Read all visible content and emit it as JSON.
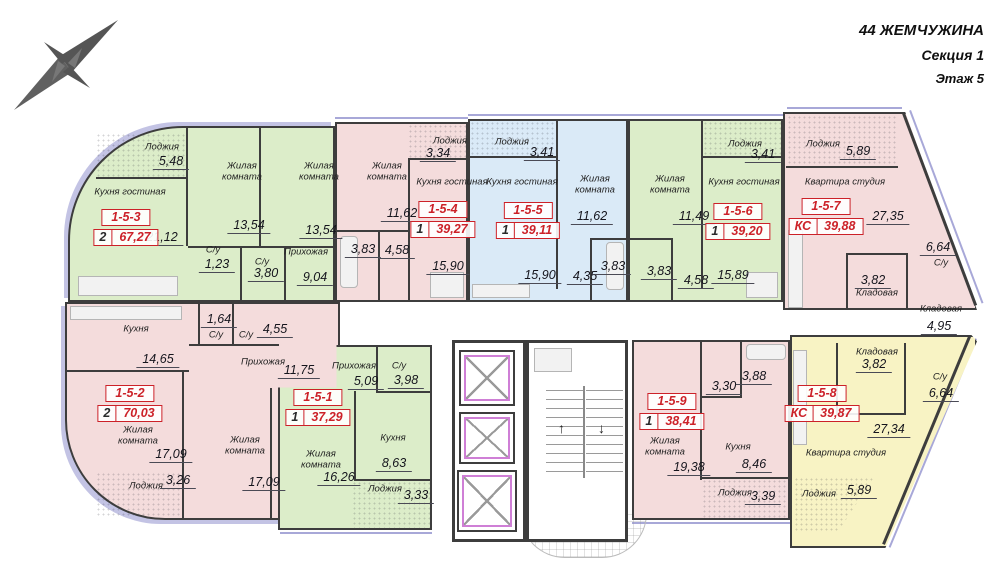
{
  "header": {
    "project": "44 ЖЕМЧУЖИНА",
    "section": "Секция 1",
    "floor": "Этаж 5"
  },
  "icons": {
    "compass": "compass-rose-icon",
    "elevator": "elevator-cabin",
    "stairs": "staircase",
    "entrance": "entrance-canopy"
  },
  "colors": {
    "room_green": "#dcedc9",
    "room_pink": "#f4dcdc",
    "room_blue": "#daeaf7",
    "room_yellow": "#f8f3c4",
    "highlight_red": "#cc2128",
    "wall": "#3d3d3d",
    "window": "#a8a8d8"
  },
  "corridor": {
    "storage_name": "Кладовая",
    "storage_area": "4,95"
  },
  "apartments": [
    {
      "id": "1-5-1",
      "count": "1",
      "total": "37,29",
      "rooms": [
        {
          "name": "Прихожая",
          "area": "5,09"
        },
        {
          "name": "С/у",
          "area": "3,98"
        },
        {
          "name": "Кухня",
          "area": "8,63"
        },
        {
          "name": "Жилая комната",
          "area": "16,26"
        },
        {
          "name": "Лоджия",
          "area": "3,33"
        }
      ]
    },
    {
      "id": "1-5-2",
      "count": "2",
      "total": "70,03",
      "rooms": [
        {
          "name": "Кухня",
          "area": "14,65"
        },
        {
          "name": "С/у",
          "area": "1,64"
        },
        {
          "name": "С/у",
          "area": "4,55"
        },
        {
          "name": "Прихожая",
          "area": "11,75"
        },
        {
          "name": "Жилая комната",
          "area": "17,09"
        },
        {
          "name": "Лоджия",
          "area": "3,26"
        },
        {
          "name": "Жилая комната",
          "area": "17,09"
        }
      ]
    },
    {
      "id": "1-5-3",
      "count": "2",
      "total": "67,27",
      "rooms": [
        {
          "name": "Лоджия",
          "area": "5,48"
        },
        {
          "name": "Кухня гостиная",
          "area": "21,12"
        },
        {
          "name": "Жилая комната",
          "area": "13,54"
        },
        {
          "name": "Жилая комната",
          "area": "13,54"
        },
        {
          "name": "С/у",
          "area": "1,23"
        },
        {
          "name": "С/у",
          "area": "3,80"
        },
        {
          "name": "Прихожая",
          "area": "9,04"
        }
      ]
    },
    {
      "id": "1-5-4",
      "count": "1",
      "total": "39,27",
      "rooms": [
        {
          "name": "Лоджия",
          "area": "3,34"
        },
        {
          "name": "Жилая комната",
          "area": "11,62"
        },
        {
          "name": "Кухня гостиная",
          "area": "15,90"
        },
        {
          "name": "",
          "area": "3,83"
        },
        {
          "name": "",
          "area": "4,58"
        }
      ]
    },
    {
      "id": "1-5-5",
      "count": "1",
      "total": "39,11",
      "rooms": [
        {
          "name": "Лоджия",
          "area": "3,41"
        },
        {
          "name": "Кухня гостиная",
          "area": "15,90"
        },
        {
          "name": "Жилая комната",
          "area": "11,62"
        },
        {
          "name": "",
          "area": "4,35"
        },
        {
          "name": "",
          "area": "3,83"
        }
      ]
    },
    {
      "id": "1-5-6",
      "count": "1",
      "total": "39,20",
      "rooms": [
        {
          "name": "Жилая комната",
          "area": "11,49"
        },
        {
          "name": "Лоджия",
          "area": "3,41"
        },
        {
          "name": "Кухня гостиная",
          "area": "15,89"
        },
        {
          "name": "",
          "area": "3,83"
        },
        {
          "name": "",
          "area": "4,58"
        }
      ]
    },
    {
      "id": "1-5-7",
      "count": "КС",
      "total": "39,88",
      "rooms": [
        {
          "name": "Лоджия",
          "area": "5,89"
        },
        {
          "name": "Квартира студия",
          "area": "27,35"
        },
        {
          "name": "С/у",
          "area": "6,64"
        },
        {
          "name": "Кладовая",
          "area": "3,82"
        }
      ]
    },
    {
      "id": "1-5-8",
      "count": "КС",
      "total": "39,87",
      "rooms": [
        {
          "name": "Кладовая",
          "area": "3,82"
        },
        {
          "name": "С/у",
          "area": "6,64"
        },
        {
          "name": "Квартира студия",
          "area": "27,34"
        },
        {
          "name": "Лоджия",
          "area": "5,89"
        }
      ]
    },
    {
      "id": "1-5-9",
      "count": "1",
      "total": "38,41",
      "rooms": [
        {
          "name": "Жилая комната",
          "area": "19,38"
        },
        {
          "name": "",
          "area": "3,30"
        },
        {
          "name": "",
          "area": "3,88"
        },
        {
          "name": "Кухня",
          "area": "8,46"
        },
        {
          "name": "Лоджия",
          "area": "3,39"
        }
      ]
    }
  ]
}
